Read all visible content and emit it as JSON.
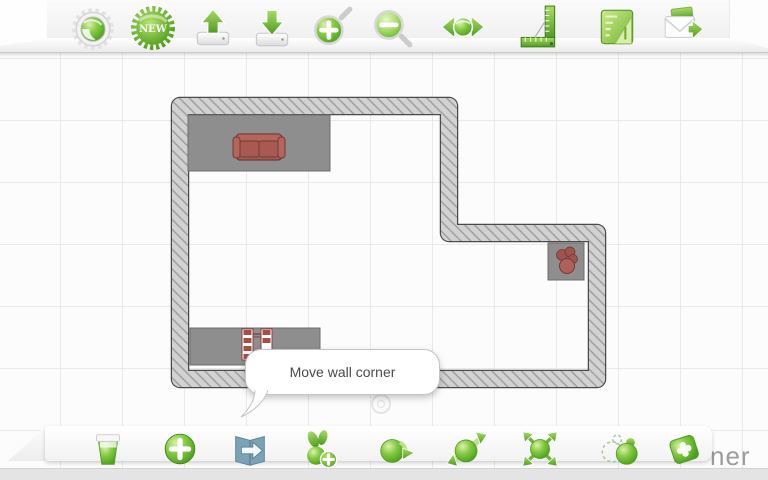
{
  "app": {
    "watermark_fragment": "ner",
    "accent_color": "#5aa823"
  },
  "top_toolbar": {
    "new_badge_label": "NEW",
    "icons": [
      "settings-icon",
      "new-badge",
      "upload-icon",
      "download-icon",
      "zoom-in-icon",
      "zoom-out-icon",
      "pan-icon",
      "ruler-icon",
      "plan-document-icon",
      "share-icon"
    ]
  },
  "bottom_toolbar": {
    "icons": [
      "delete-icon",
      "add-icon",
      "export-icon",
      "add-furniture-icon",
      "rotate-icon",
      "flip-icon",
      "scale-icon",
      "copy-icon",
      "texture-icon"
    ]
  },
  "canvas": {
    "tooltip": {
      "text": "Move wall corner"
    },
    "grid_spacing_px": 62,
    "colors": {
      "canvas_bg": "#fcfcfc",
      "grid_line": "#e9e9e9",
      "wall_fill": "#d2d2d2",
      "wall_hatch": "#9b9b9b",
      "wall_outline": "#4a4a4a",
      "zone_gray": "#8e8e8e",
      "furniture_red": "#a85a52"
    },
    "floor_plan": {
      "outer_corners_px": [
        [
          172,
          98
        ],
        [
          457,
          98
        ],
        [
          457,
          225
        ],
        [
          605,
          225
        ],
        [
          605,
          387
        ],
        [
          172,
          387
        ]
      ],
      "wall_thickness_px": 16
    },
    "zones": [
      {
        "name": "sofa-zone",
        "x": 188,
        "y": 115,
        "w": 142,
        "h": 56
      },
      {
        "name": "shelf-zone",
        "x": 190,
        "y": 328,
        "w": 130,
        "h": 37
      },
      {
        "name": "plant-zone",
        "x": 548,
        "y": 243,
        "w": 36,
        "h": 37
      }
    ],
    "furniture": [
      "sofa",
      "shelf",
      "potted-plant"
    ],
    "handle": {
      "x": 381,
      "y": 404
    }
  }
}
